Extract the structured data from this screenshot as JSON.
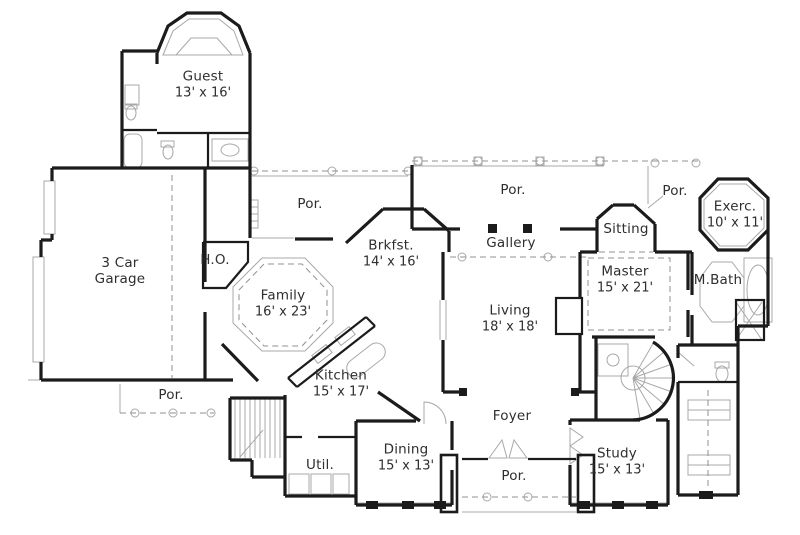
{
  "plan": {
    "type": "first-floor-plan",
    "colors": {
      "wall": "#1b1b1b",
      "thin_line": "#a8a8a8",
      "dashed_line": "#909090",
      "label_text": "#2e2e2e",
      "background": "#ffffff"
    },
    "rooms": {
      "guest": {
        "name": "Guest",
        "dims": "13' x 16'"
      },
      "garage": {
        "name": "3 Car Garage",
        "dims": ""
      },
      "ho": {
        "name": "H.O.",
        "dims": ""
      },
      "por_left": {
        "name": "Por.",
        "dims": ""
      },
      "brkfst": {
        "name": "Brkfst.",
        "dims": "14' x 16'"
      },
      "family": {
        "name": "Family",
        "dims": "16' x 23'"
      },
      "kitchen": {
        "name": "Kitchen",
        "dims": "15' x 17'"
      },
      "por_top": {
        "name": "Por.",
        "dims": ""
      },
      "gallery": {
        "name": "Gallery",
        "dims": ""
      },
      "living": {
        "name": "Living",
        "dims": "18' x 18'"
      },
      "sitting": {
        "name": "Sitting",
        "dims": ""
      },
      "master": {
        "name": "Master",
        "dims": "15' x 21'"
      },
      "por_top_right": {
        "name": "Por.",
        "dims": ""
      },
      "exerc": {
        "name": "Exerc.",
        "dims": "10' x 11'"
      },
      "mbath": {
        "name": "M.Bath",
        "dims": ""
      },
      "por_bottom_left": {
        "name": "Por.",
        "dims": ""
      },
      "util": {
        "name": "Util.",
        "dims": ""
      },
      "dining": {
        "name": "Dining",
        "dims": "15' x 13'"
      },
      "foyer": {
        "name": "Foyer",
        "dims": ""
      },
      "por_bottom": {
        "name": "Por.",
        "dims": ""
      },
      "study": {
        "name": "Study",
        "dims": "15' x 13'"
      }
    }
  }
}
